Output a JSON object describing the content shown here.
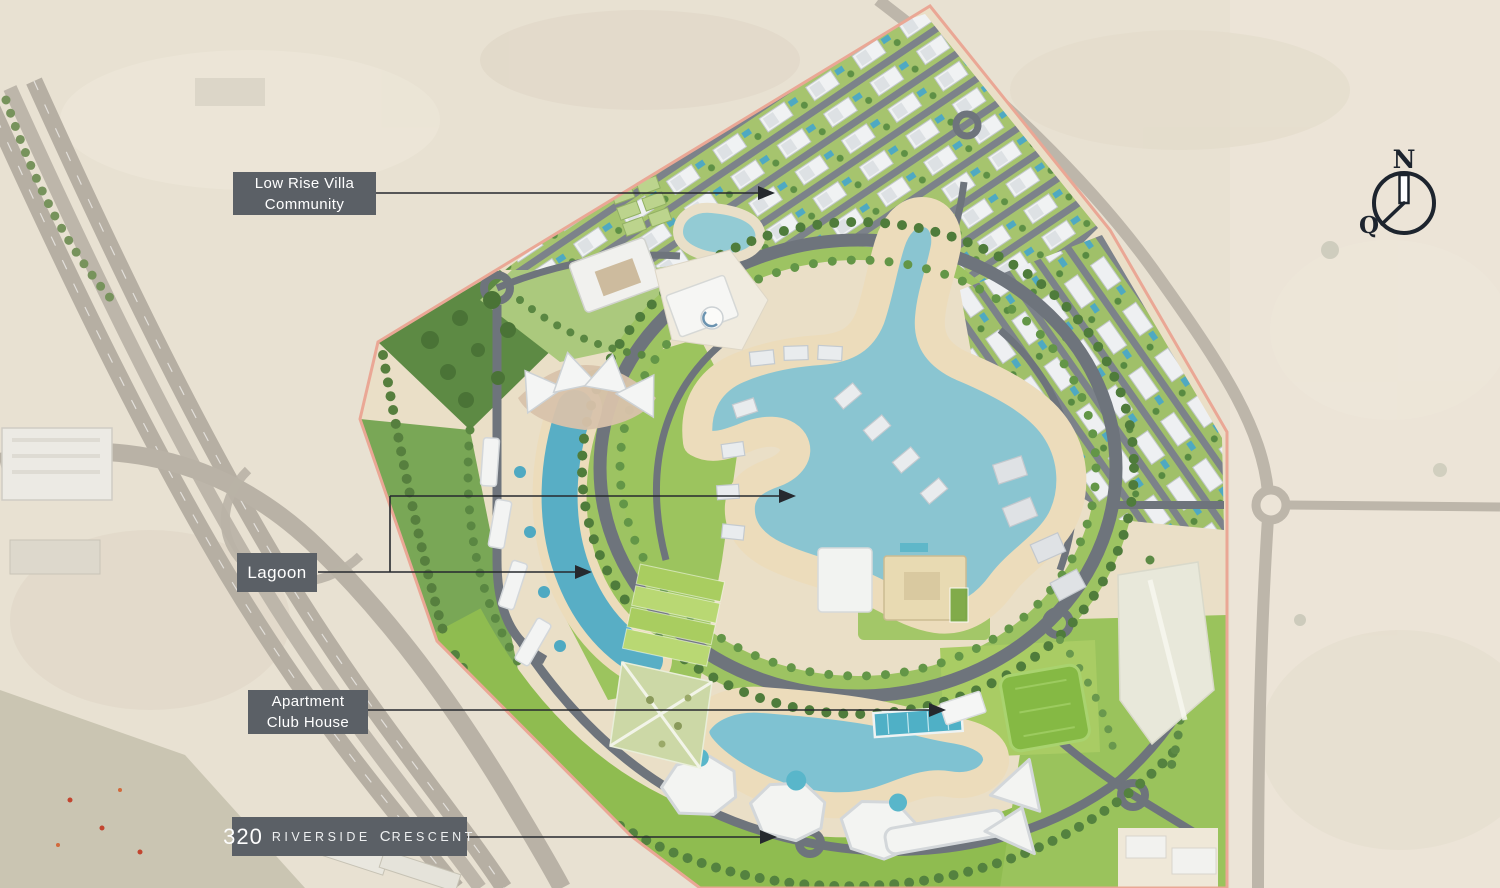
{
  "annotations": {
    "low_rise_villa_community": {
      "label": "Low Rise Villa Community"
    },
    "lagoon": {
      "label": "Lagoon"
    },
    "apartment_club_house": {
      "label": "Apartment Club House"
    },
    "riverside_crescent": {
      "number": "320",
      "word1": "RIVERSIDE",
      "word2_initial": "C",
      "word2_rest": "RESCENT"
    }
  },
  "compass": {
    "north": "N",
    "qibla": "Q"
  },
  "colors": {
    "label_background": "#5b6066",
    "label_text": "#ffffff",
    "leader_line": "#26292e",
    "site_boundary": "#eaa795",
    "desert": "#e8e1d2",
    "site_sand": "#eadfc7",
    "greenery": "#9cc45e",
    "lagoon_water": "#8ac5d1",
    "canal_water": "#58aec5",
    "south_lagoon_water": "#7fc2d2",
    "road": "#6e747c",
    "building": "#f3f4f3",
    "compass_ink": "#1d242e"
  }
}
